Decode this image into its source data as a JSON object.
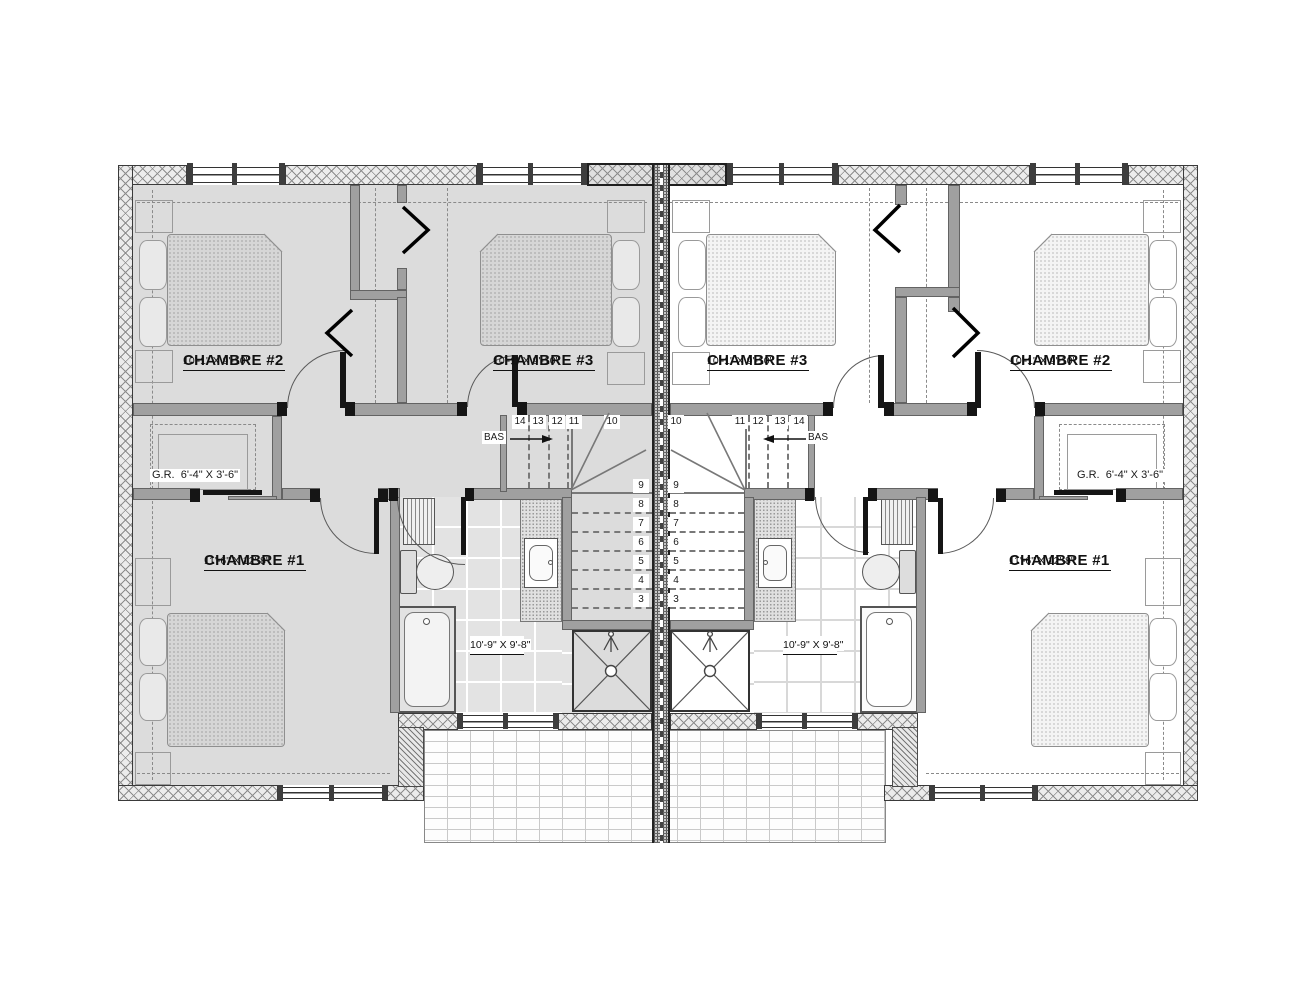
{
  "units": {
    "left": {
      "ch2_name": "CHAMBRE #2",
      "ch2_dims": "10'-1\" X 9'-10\"",
      "ch3_name": "CHAMBRE #3",
      "ch3_dims": "10'-1\" X 9'-10\"",
      "ch1_name": "CHAMBRE #1",
      "ch1_dims": "11'-6\" X 12'-8\"",
      "sbain_name": "S.BAIN",
      "sbain_dims": "10'-9\" X 9'-8\"",
      "gr_label": "G.R.  6'-4\" X 3'-6\"",
      "bas": "BAS"
    },
    "right": {
      "ch2_name": "CHAMBRE #2",
      "ch2_dims": "10'-1\" X 9'-10\"",
      "ch3_name": "CHAMBRE #3",
      "ch3_dims": "10'-1\" X 9'-10\"",
      "ch1_name": "CHAMBRE #1",
      "ch1_dims": "11'-6\" X 12'-8\"",
      "sbain_name": "S.BAIN",
      "sbain_dims": "10'-9\" X 9'-8\"",
      "gr_label": "G.R.  6'-4\" X 3'-6\"",
      "bas": "BAS"
    }
  },
  "stairs": {
    "left_upper": [
      "14",
      "13",
      "12",
      "11",
      "10"
    ],
    "left_lower": [
      "9",
      "8",
      "7",
      "6",
      "5",
      "4",
      "3"
    ],
    "right_upper": [
      "10",
      "11",
      "12",
      "13",
      "14"
    ],
    "right_lower": [
      "9",
      "8",
      "7",
      "6",
      "5",
      "4",
      "3"
    ]
  },
  "colors": {
    "left_unit_floor": "#dcdcdc",
    "right_unit_floor": "#ffffff",
    "wall_gray": "#a0a0a0"
  }
}
